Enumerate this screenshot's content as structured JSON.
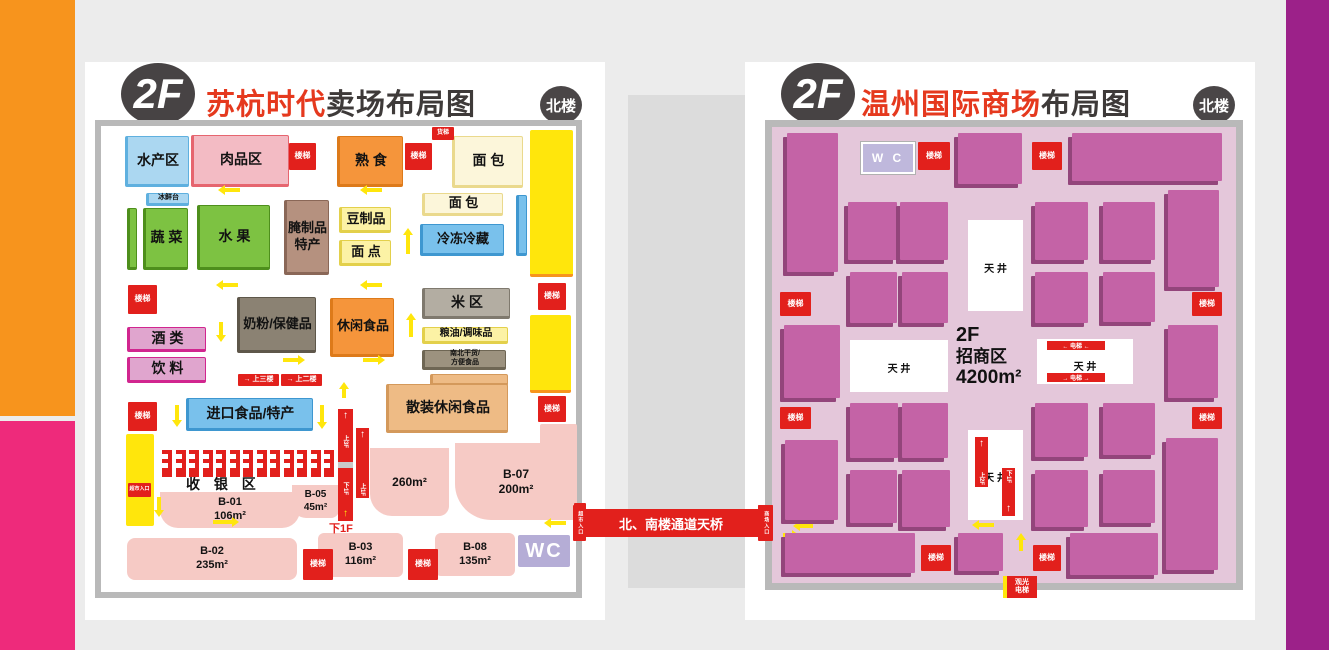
{
  "page": {
    "decor": {
      "orange": "#f7941d",
      "pink": "#ee2a7b",
      "purple": "#9c2189"
    }
  },
  "left_panel": {
    "floor": "2F",
    "title_red": "苏杭时代",
    "title_dark": "卖场布局图",
    "corner_badge": "北楼"
  },
  "right_panel": {
    "floor": "2F",
    "title_red": "温州国际商场",
    "title_dark": "布局图",
    "corner_badge": "北楼",
    "center_text": {
      "line1": "2F",
      "line2": "招商区",
      "line3": "4200m²"
    },
    "elevator_badge_top": "← 电梯 ←",
    "elevator_badge_bottom": "→ 电梯 →",
    "wc": "W C",
    "sightseeing_elevator": "观光\n电梯"
  },
  "bridge": {
    "label": "北、南楼通道天桥",
    "left_tab": "超市入口",
    "right_tab": "商场入口"
  },
  "left_map": {
    "zones": [
      {
        "name": "zone-seafood",
        "label": "水产区",
        "cls": "blue2",
        "x": 125,
        "y": 136,
        "w": 64,
        "h": 51,
        "fs": 14
      },
      {
        "name": "zone-meat",
        "label": "肉品区",
        "cls": "pink",
        "x": 191,
        "y": 135,
        "w": 98,
        "h": 52,
        "fs": 14
      },
      {
        "name": "zone-cooked-food",
        "label": "熟 食",
        "cls": "orange",
        "x": 337,
        "y": 136,
        "w": 66,
        "h": 51,
        "fs": 14
      },
      {
        "name": "zone-bread-1",
        "label": "面 包",
        "cls": "cream",
        "x": 452,
        "y": 136,
        "w": 71,
        "h": 52,
        "fs": 14
      },
      {
        "name": "yellow-strip-1",
        "label": "",
        "cls": "yellow",
        "x": 530,
        "y": 130,
        "w": 43,
        "h": 147,
        "bb": 1
      },
      {
        "name": "yellow-strip-2",
        "label": "",
        "cls": "yellow",
        "x": 530,
        "y": 315,
        "w": 41,
        "h": 78,
        "bb": 1
      },
      {
        "name": "zone-ice-counter",
        "label": "冰鲜台",
        "cls": "blue2",
        "x": 146,
        "y": 193,
        "w": 43,
        "h": 13,
        "fs": 7
      },
      {
        "name": "green-strip",
        "label": "",
        "cls": "green",
        "x": 127,
        "y": 208,
        "w": 10,
        "h": 62
      },
      {
        "name": "zone-vegetables",
        "label": "蔬 菜",
        "cls": "green",
        "x": 143,
        "y": 208,
        "w": 45,
        "h": 62,
        "fs": 14
      },
      {
        "name": "zone-fruits",
        "label": "水 果",
        "cls": "green",
        "x": 197,
        "y": 205,
        "w": 73,
        "h": 65,
        "fs": 14
      },
      {
        "name": "zone-pickled",
        "label": "腌制品\n特产",
        "cls": "tan",
        "x": 284,
        "y": 200,
        "w": 45,
        "h": 75,
        "fs": 13
      },
      {
        "name": "zone-tofu",
        "label": "豆制品",
        "cls": "ypale",
        "x": 339,
        "y": 207,
        "w": 52,
        "h": 26,
        "fs": 13
      },
      {
        "name": "zone-pastry",
        "label": "面 点",
        "cls": "ypale",
        "x": 339,
        "y": 240,
        "w": 52,
        "h": 26,
        "fs": 13
      },
      {
        "name": "zone-bread-2",
        "label": "面 包",
        "cls": "cream",
        "x": 422,
        "y": 193,
        "w": 81,
        "h": 23,
        "fs": 13
      },
      {
        "name": "zone-frozen",
        "label": "冷冻冷藏",
        "cls": "blue",
        "x": 420,
        "y": 224,
        "w": 84,
        "h": 32,
        "fs": 13
      },
      {
        "name": "blue-strip",
        "label": "",
        "cls": "blue",
        "x": 516,
        "y": 195,
        "w": 11,
        "h": 61
      },
      {
        "name": "zone-milk-health",
        "label": "奶粉/保健品",
        "cls": "taupe",
        "x": 237,
        "y": 297,
        "w": 79,
        "h": 56,
        "fs": 13
      },
      {
        "name": "zone-snack-food",
        "label": "休闲食品",
        "cls": "orange",
        "x": 330,
        "y": 298,
        "w": 64,
        "h": 59,
        "fs": 13
      },
      {
        "name": "zone-rice",
        "label": "米  区",
        "cls": "gray",
        "x": 422,
        "y": 288,
        "w": 88,
        "h": 31,
        "fs": 14
      },
      {
        "name": "zone-grain-oil",
        "label": "粮油/调味品",
        "cls": "ypale",
        "x": 422,
        "y": 327,
        "w": 86,
        "h": 17,
        "fs": 10
      },
      {
        "name": "zone-dry-goods",
        "label": "南北干货/\n方便食品",
        "cls": "taupe2",
        "x": 422,
        "y": 350,
        "w": 84,
        "h": 20,
        "fs": 7
      },
      {
        "name": "zone-wine",
        "label": "酒 类",
        "cls": "lilac",
        "x": 127,
        "y": 327,
        "w": 79,
        "h": 25,
        "fs": 14
      },
      {
        "name": "zone-drinks",
        "label": "饮 料",
        "cls": "lilac",
        "x": 127,
        "y": 357,
        "w": 79,
        "h": 26,
        "fs": 14
      },
      {
        "name": "zone-bulk-snacks-top",
        "label": "",
        "cls": "tan2",
        "x": 430,
        "y": 374,
        "w": 78,
        "h": 12
      },
      {
        "name": "zone-bulk-snacks",
        "label": "散装休闲食品",
        "cls": "tan2",
        "x": 386,
        "y": 384,
        "w": 122,
        "h": 49,
        "fs": 14
      },
      {
        "name": "zone-imported-food",
        "label": "进口食品/特产",
        "cls": "blue",
        "x": 186,
        "y": 398,
        "w": 127,
        "h": 33,
        "fs": 14
      },
      {
        "name": "yellow-block",
        "label": "",
        "cls": "yellow",
        "x": 126,
        "y": 434,
        "w": 28,
        "h": 92
      },
      {
        "name": "zone-b01",
        "label": "B-01\n106m²",
        "cls": "plight",
        "x": 160,
        "y": 492,
        "w": 140,
        "h": 36,
        "fs": 11,
        "r": "0 0 18px 18px"
      },
      {
        "name": "zone-b05",
        "label": "B-05\n45m²",
        "cls": "plight",
        "x": 292,
        "y": 485,
        "w": 47,
        "h": 33,
        "fs": 10,
        "r": "0 0 8px 14px"
      },
      {
        "name": "zone-260",
        "label": "260m²",
        "cls": "plight",
        "x": 370,
        "y": 448,
        "w": 79,
        "h": 68,
        "fs": 12,
        "r": "0 0 10px 22px"
      },
      {
        "name": "zone-b07-strip",
        "label": "",
        "cls": "plight",
        "x": 540,
        "y": 424,
        "w": 37,
        "h": 30
      },
      {
        "name": "zone-b07",
        "label": "B-07\n200m²",
        "cls": "plight",
        "x": 455,
        "y": 443,
        "w": 122,
        "h": 77,
        "fs": 12,
        "r": "0 0 0 36px"
      },
      {
        "name": "zone-b02",
        "label": "B-02\n235m²",
        "cls": "plight",
        "x": 127,
        "y": 538,
        "w": 170,
        "h": 42,
        "fs": 11,
        "r": "8px"
      },
      {
        "name": "zone-b03",
        "label": "B-03\n116m²",
        "cls": "plight",
        "x": 318,
        "y": 533,
        "w": 85,
        "h": 44,
        "fs": 11,
        "r": "6px"
      },
      {
        "name": "zone-b08",
        "label": "B-08\n135m²",
        "cls": "plight",
        "x": 435,
        "y": 533,
        "w": 80,
        "h": 43,
        "fs": 11,
        "r": "6px"
      },
      {
        "name": "zone-wc",
        "label": "WC",
        "cls": "lav",
        "x": 518,
        "y": 535,
        "w": 52,
        "h": 32,
        "fs": 20
      }
    ],
    "badges": [
      {
        "name": "stairs-badge",
        "label": "楼梯",
        "x": 289,
        "y": 143,
        "w": 27,
        "h": 27,
        "fs": 8
      },
      {
        "name": "stairs-badge",
        "label": "楼梯",
        "x": 405,
        "y": 143,
        "w": 27,
        "h": 27,
        "fs": 8
      },
      {
        "name": "freight-elevator-badge",
        "label": "货梯",
        "x": 432,
        "y": 127,
        "w": 22,
        "h": 13,
        "fs": 6
      },
      {
        "name": "stairs-badge",
        "label": "楼梯",
        "x": 538,
        "y": 283,
        "w": 28,
        "h": 27,
        "fs": 8
      },
      {
        "name": "stairs-badge",
        "label": "楼梯",
        "x": 538,
        "y": 396,
        "w": 28,
        "h": 26,
        "fs": 8
      },
      {
        "name": "stairs-badge",
        "label": "楼梯",
        "x": 128,
        "y": 285,
        "w": 29,
        "h": 29,
        "fs": 8
      },
      {
        "name": "stairs-badge",
        "label": "楼梯",
        "x": 128,
        "y": 402,
        "w": 29,
        "h": 29,
        "fs": 8
      },
      {
        "name": "stairs-badge",
        "label": "楼梯",
        "x": 303,
        "y": 549,
        "w": 30,
        "h": 31,
        "fs": 8
      },
      {
        "name": "stairs-badge",
        "label": "楼梯",
        "x": 408,
        "y": 549,
        "w": 30,
        "h": 31,
        "fs": 8
      },
      {
        "name": "up-3f-badge",
        "label": "→ 上三楼",
        "x": 238,
        "y": 374,
        "w": 41,
        "h": 12,
        "fs": 7
      },
      {
        "name": "up-2f-badge",
        "label": "→ 上二楼",
        "x": 281,
        "y": 374,
        "w": 41,
        "h": 12,
        "fs": 7
      },
      {
        "name": "supermarket-entrance-badge",
        "label": "超市入口",
        "x": 128,
        "y": 483,
        "w": 23,
        "h": 14,
        "fs": 5
      },
      {
        "name": "exit-mini-badge",
        "label": "出口",
        "x": 341,
        "y": 484,
        "w": 10,
        "h": 16,
        "fs": 5,
        "vert": 1
      },
      {
        "name": "supermarket-entrance-badge",
        "label": "超市入口",
        "x": 574,
        "y": 503,
        "w": 12,
        "h": 32,
        "fs": 5,
        "vert": 1
      }
    ],
    "escalators": [
      {
        "name": "escalator-main",
        "x": 338,
        "y": 409,
        "w": 15,
        "h": 112,
        "parts": [
          {
            "a": "w"
          },
          {
            "t": "上3F"
          },
          {
            "gap": 1
          },
          {
            "t": "下1F"
          },
          {
            "a": "y"
          }
        ]
      },
      {
        "name": "escalator-side",
        "x": 356,
        "y": 428,
        "w": 13,
        "h": 70,
        "parts": [
          {
            "a": "w"
          },
          {
            "t": "上1F"
          }
        ]
      }
    ],
    "texts": [
      {
        "name": "down-1f-label",
        "text": "下1F",
        "x": 329,
        "y": 520,
        "fs": 11,
        "color": "#e2201c"
      },
      {
        "name": "cashier-area-label",
        "text": "收 银 区",
        "x": 186,
        "y": 474,
        "fs": 14,
        "color": "#111111",
        "ls": 5
      }
    ],
    "checkout": {
      "count": 13,
      "x": 162,
      "y": 450,
      "step": 13.5
    },
    "arrows": [
      {
        "x": 218,
        "y": 185,
        "dir": "left",
        "len": 22
      },
      {
        "x": 360,
        "y": 185,
        "dir": "left",
        "len": 22
      },
      {
        "x": 403,
        "y": 228,
        "dir": "up",
        "len": 26
      },
      {
        "x": 216,
        "y": 280,
        "dir": "left",
        "len": 22
      },
      {
        "x": 360,
        "y": 280,
        "dir": "left",
        "len": 22
      },
      {
        "x": 216,
        "y": 322,
        "dir": "down",
        "len": 20
      },
      {
        "x": 406,
        "y": 313,
        "dir": "up",
        "len": 24
      },
      {
        "x": 283,
        "y": 355,
        "dir": "right",
        "len": 22
      },
      {
        "x": 363,
        "y": 355,
        "dir": "right",
        "len": 22
      },
      {
        "x": 172,
        "y": 405,
        "dir": "down",
        "len": 22
      },
      {
        "x": 317,
        "y": 405,
        "dir": "down",
        "len": 24
      },
      {
        "x": 339,
        "y": 382,
        "dir": "up",
        "len": 16
      },
      {
        "x": 154,
        "y": 497,
        "dir": "down",
        "len": 20
      },
      {
        "x": 213,
        "y": 517,
        "dir": "right",
        "len": 26
      },
      {
        "x": 544,
        "y": 518,
        "dir": "left",
        "len": 22
      }
    ]
  },
  "right_map": {
    "blocks": [
      {
        "x": 787,
        "y": 133,
        "w": 51,
        "h": 139
      },
      {
        "x": 958,
        "y": 133,
        "w": 64,
        "h": 51
      },
      {
        "x": 1072,
        "y": 133,
        "w": 150,
        "h": 48
      },
      {
        "x": 1168,
        "y": 190,
        "w": 51,
        "h": 97
      },
      {
        "x": 848,
        "y": 202,
        "w": 49,
        "h": 58
      },
      {
        "x": 900,
        "y": 202,
        "w": 48,
        "h": 58
      },
      {
        "x": 1035,
        "y": 202,
        "w": 53,
        "h": 58
      },
      {
        "x": 1103,
        "y": 202,
        "w": 52,
        "h": 58
      },
      {
        "x": 850,
        "y": 272,
        "w": 47,
        "h": 51
      },
      {
        "x": 902,
        "y": 272,
        "w": 46,
        "h": 51
      },
      {
        "x": 1035,
        "y": 272,
        "w": 53,
        "h": 51
      },
      {
        "x": 1103,
        "y": 272,
        "w": 52,
        "h": 50
      },
      {
        "x": 784,
        "y": 325,
        "w": 56,
        "h": 73
      },
      {
        "x": 1168,
        "y": 325,
        "w": 50,
        "h": 73
      },
      {
        "x": 850,
        "y": 403,
        "w": 48,
        "h": 55
      },
      {
        "x": 902,
        "y": 403,
        "w": 46,
        "h": 55
      },
      {
        "x": 1035,
        "y": 403,
        "w": 53,
        "h": 54
      },
      {
        "x": 1103,
        "y": 403,
        "w": 52,
        "h": 52
      },
      {
        "x": 785,
        "y": 440,
        "w": 53,
        "h": 80
      },
      {
        "x": 850,
        "y": 470,
        "w": 47,
        "h": 53
      },
      {
        "x": 902,
        "y": 470,
        "w": 48,
        "h": 57
      },
      {
        "x": 1035,
        "y": 470,
        "w": 53,
        "h": 57
      },
      {
        "x": 1103,
        "y": 470,
        "w": 52,
        "h": 53
      },
      {
        "x": 785,
        "y": 533,
        "w": 130,
        "h": 40
      },
      {
        "x": 958,
        "y": 533,
        "w": 45,
        "h": 38
      },
      {
        "x": 1070,
        "y": 533,
        "w": 88,
        "h": 42
      },
      {
        "x": 1166,
        "y": 438,
        "w": 52,
        "h": 132
      }
    ],
    "stairs": [
      {
        "label": "楼梯",
        "x": 918,
        "y": 142,
        "w": 32,
        "h": 28,
        "fs": 8
      },
      {
        "label": "楼梯",
        "x": 1032,
        "y": 142,
        "w": 30,
        "h": 28,
        "fs": 8
      },
      {
        "label": "楼梯",
        "x": 780,
        "y": 292,
        "w": 31,
        "h": 24,
        "fs": 8
      },
      {
        "label": "楼梯",
        "x": 780,
        "y": 407,
        "w": 31,
        "h": 22,
        "fs": 8
      },
      {
        "label": "楼梯",
        "x": 1192,
        "y": 292,
        "w": 30,
        "h": 24,
        "fs": 8
      },
      {
        "label": "楼梯",
        "x": 1192,
        "y": 407,
        "w": 30,
        "h": 22,
        "fs": 8
      },
      {
        "label": "楼梯",
        "x": 921,
        "y": 545,
        "w": 30,
        "h": 26,
        "fs": 8
      },
      {
        "label": "楼梯",
        "x": 1033,
        "y": 545,
        "w": 28,
        "h": 26,
        "fs": 8
      }
    ],
    "atria": [
      {
        "name": "atrium-top",
        "label": "天 井",
        "x": 968,
        "y": 220,
        "w": 55,
        "h": 91
      },
      {
        "name": "atrium-left",
        "label": "天 井",
        "x": 850,
        "y": 340,
        "w": 98,
        "h": 52
      },
      {
        "name": "atrium-elevators",
        "label": "天 井",
        "x": 1037,
        "y": 339,
        "w": 96,
        "h": 45,
        "elevators": 1
      },
      {
        "name": "atrium-escalators",
        "label": "天 井",
        "x": 968,
        "y": 430,
        "w": 55,
        "h": 90,
        "strips": [
          {
            "x": 975,
            "y": 437,
            "w": 13,
            "h": 50,
            "parts": [
              {
                "a": "w"
              },
              {
                "t": "上2F"
              }
            ]
          },
          {
            "x": 1002,
            "y": 468,
            "w": 13,
            "h": 48,
            "parts": [
              {
                "t": "下1F"
              },
              {
                "a": "w"
              }
            ]
          }
        ]
      }
    ],
    "badges": [
      {
        "name": "mall-entrance-badge",
        "label": "商场入口",
        "x": 758,
        "y": 505,
        "w": 15,
        "h": 34,
        "fs": 5,
        "vert": 1
      }
    ],
    "arrows": [
      {
        "x": 793,
        "y": 521,
        "dir": "left",
        "len": 20
      },
      {
        "x": 972,
        "y": 520,
        "dir": "left",
        "len": 22
      },
      {
        "x": 1016,
        "y": 533,
        "dir": "up",
        "len": 18
      },
      {
        "x": 783,
        "y": 514,
        "dir": "left",
        "len": 16
      },
      {
        "x": 783,
        "y": 530,
        "dir": "right",
        "len": 16
      }
    ]
  }
}
